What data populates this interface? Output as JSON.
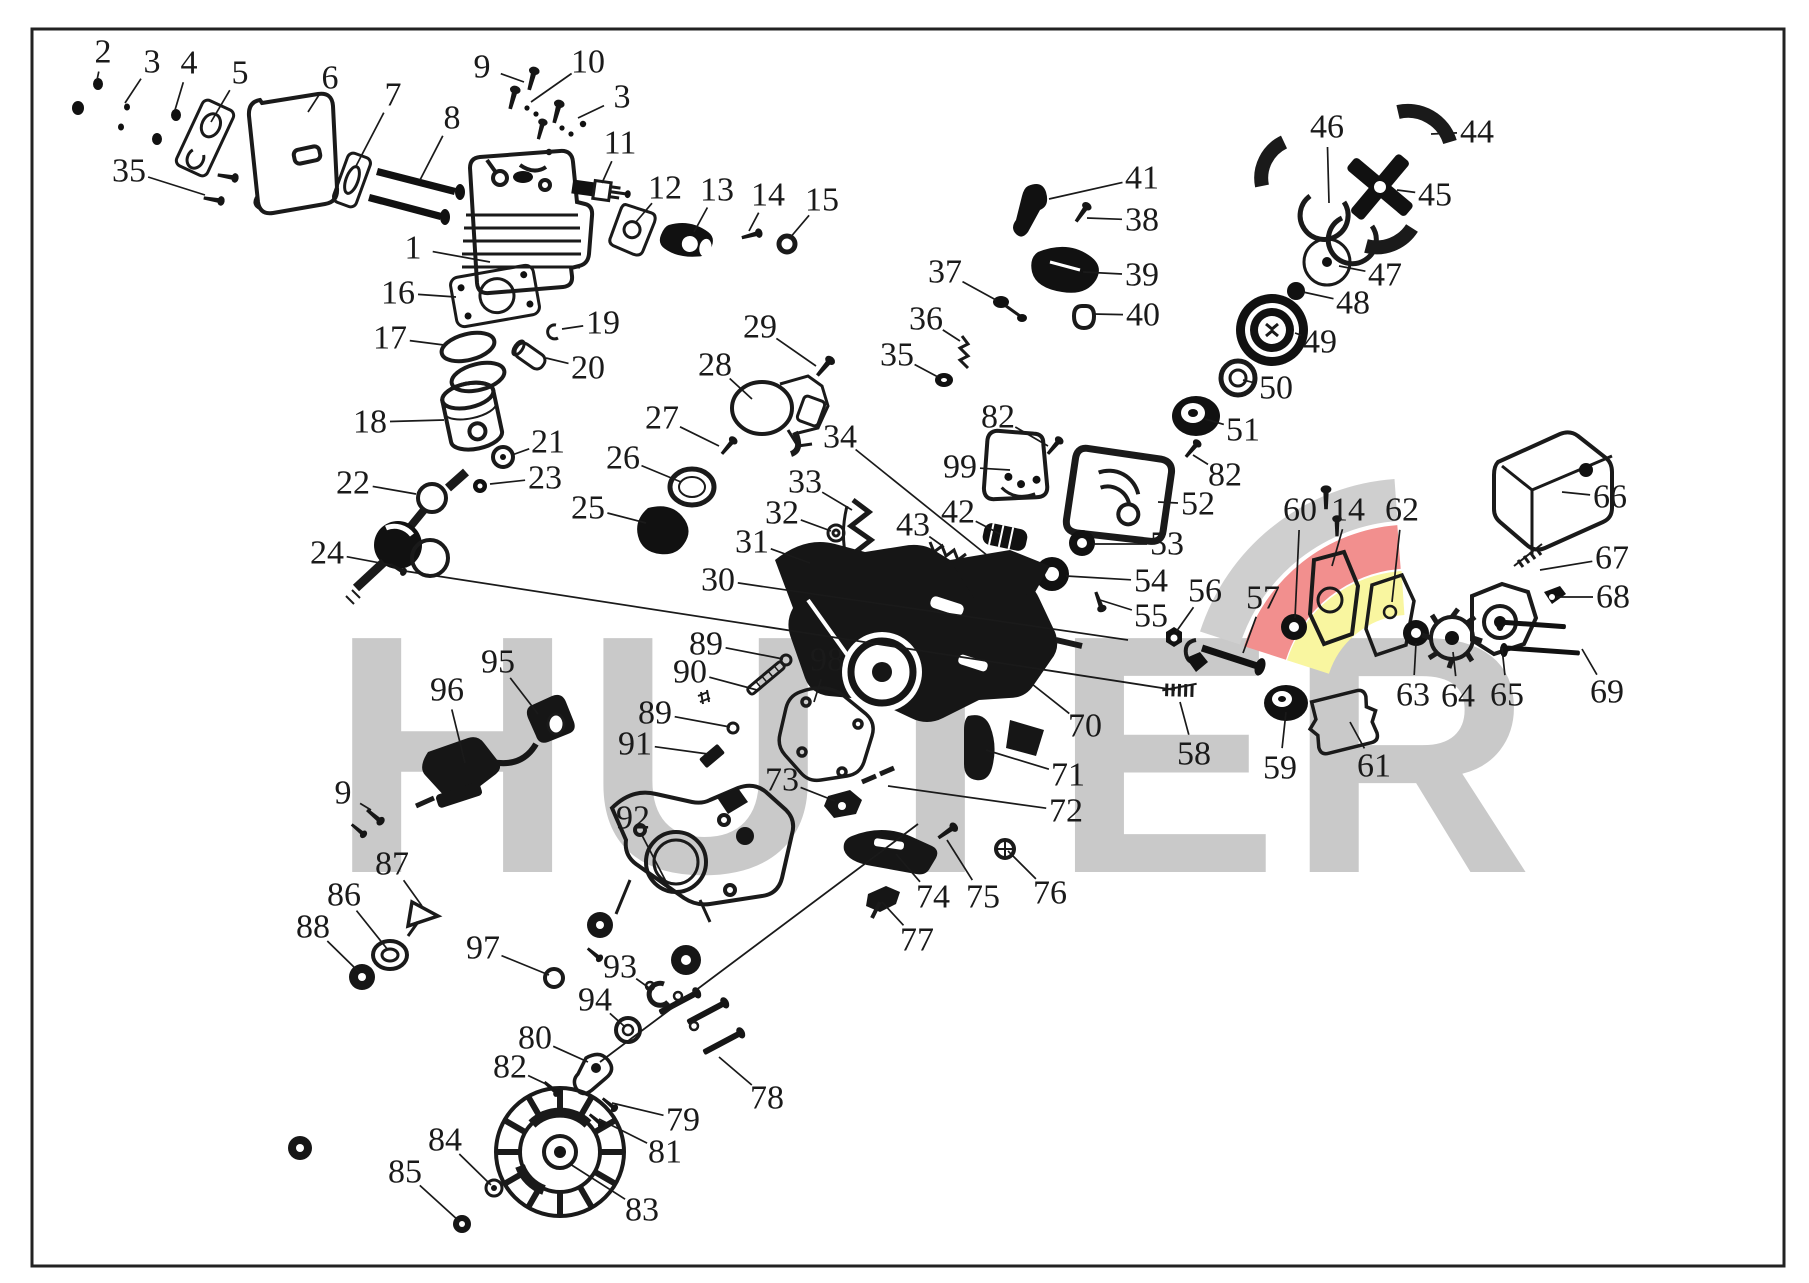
{
  "meta": {
    "kind": "exploded-parts-diagram",
    "canvas": {
      "width": 1809,
      "height": 1283,
      "background": "#ffffff"
    },
    "ink_color": "#1a1a1a",
    "frame": {
      "x": 32,
      "y": 29,
      "w": 1752,
      "h": 1237,
      "stroke": "#222222",
      "stroke_width": 3
    }
  },
  "watermark": {
    "text": "HUTER",
    "color": "#c9c9c9",
    "logo_arc_colors": {
      "gray": "#cfcfcf",
      "red": "#f28f8e",
      "yellow": "#f9f6a0"
    }
  },
  "style": {
    "label_font_size": 34,
    "leader_width": 1.7,
    "label_gap": 20
  },
  "callouts": [
    {
      "label": "1",
      "x": 413,
      "y": 248,
      "tx": 490,
      "ty": 262
    },
    {
      "label": "2",
      "x": 103,
      "y": 52,
      "tx": 97,
      "ty": 80
    },
    {
      "label": "3",
      "x": 152,
      "y": 62,
      "tx": 125,
      "ty": 103
    },
    {
      "label": "4",
      "x": 189,
      "y": 63,
      "tx": 175,
      "ty": 110
    },
    {
      "label": "5",
      "x": 240,
      "y": 73,
      "tx": 211,
      "ty": 122
    },
    {
      "label": "6",
      "x": 330,
      "y": 78,
      "tx": 308,
      "ty": 112
    },
    {
      "label": "7",
      "x": 393,
      "y": 95,
      "tx": 355,
      "ty": 168
    },
    {
      "label": "8",
      "x": 452,
      "y": 118,
      "tx": 420,
      "ty": 180
    },
    {
      "label": "9",
      "x": 482,
      "y": 67,
      "tx": 524,
      "ty": 82
    },
    {
      "label": "10",
      "x": 588,
      "y": 62,
      "tx": 531,
      "ty": 102
    },
    {
      "label": "3",
      "x": 622,
      "y": 97,
      "tx": 578,
      "ty": 118
    },
    {
      "label": "11",
      "x": 620,
      "y": 143,
      "tx": 602,
      "ty": 183
    },
    {
      "label": "12",
      "x": 665,
      "y": 188,
      "tx": 636,
      "ty": 222
    },
    {
      "label": "13",
      "x": 717,
      "y": 190,
      "tx": 694,
      "ty": 232
    },
    {
      "label": "14",
      "x": 768,
      "y": 195,
      "tx": 749,
      "ty": 231
    },
    {
      "label": "15",
      "x": 822,
      "y": 200,
      "tx": 789,
      "ty": 239
    },
    {
      "label": "16",
      "x": 398,
      "y": 293,
      "tx": 456,
      "ty": 297
    },
    {
      "label": "17",
      "x": 390,
      "y": 338,
      "tx": 444,
      "ty": 345
    },
    {
      "label": "18",
      "x": 370,
      "y": 422,
      "tx": 444,
      "ty": 420
    },
    {
      "label": "19",
      "x": 603,
      "y": 323,
      "tx": 562,
      "ty": 329
    },
    {
      "label": "20",
      "x": 588,
      "y": 368,
      "tx": 546,
      "ty": 358
    },
    {
      "label": "21",
      "x": 548,
      "y": 442,
      "tx": 512,
      "ty": 455
    },
    {
      "label": "22",
      "x": 353,
      "y": 483,
      "tx": 416,
      "ty": 494
    },
    {
      "label": "23",
      "x": 545,
      "y": 478,
      "tx": 490,
      "ty": 484
    },
    {
      "label": "24",
      "x": 327,
      "y": 553,
      "tx": 391,
      "ty": 565
    },
    {
      "label": "25",
      "x": 588,
      "y": 508,
      "tx": 646,
      "ty": 523
    },
    {
      "label": "26",
      "x": 623,
      "y": 458,
      "tx": 681,
      "ty": 482
    },
    {
      "label": "27",
      "x": 662,
      "y": 418,
      "tx": 719,
      "ty": 446
    },
    {
      "label": "28",
      "x": 715,
      "y": 365,
      "tx": 752,
      "ty": 399
    },
    {
      "label": "29",
      "x": 760,
      "y": 327,
      "tx": 816,
      "ty": 366
    },
    {
      "label": "30",
      "x": 718,
      "y": 580,
      "tx": 1128,
      "ty": 640
    },
    {
      "label": "31",
      "x": 752,
      "y": 542,
      "tx": 810,
      "ty": 563
    },
    {
      "label": "32",
      "x": 782,
      "y": 513,
      "tx": 831,
      "ty": 531
    },
    {
      "label": "33",
      "x": 805,
      "y": 482,
      "tx": 852,
      "ty": 510
    },
    {
      "label": "34",
      "x": 840,
      "y": 437,
      "tx": 988,
      "ty": 556
    },
    {
      "label": "35",
      "x": 129,
      "y": 171,
      "tx": 205,
      "ty": 195
    },
    {
      "label": "35",
      "x": 897,
      "y": 355,
      "tx": 938,
      "ty": 377
    },
    {
      "label": "36",
      "x": 926,
      "y": 319,
      "tx": 960,
      "ty": 341
    },
    {
      "label": "37",
      "x": 945,
      "y": 272,
      "tx": 996,
      "ty": 300
    },
    {
      "label": "38",
      "x": 1142,
      "y": 220,
      "tx": 1087,
      "ty": 218
    },
    {
      "label": "39",
      "x": 1142,
      "y": 275,
      "tx": 1083,
      "ty": 272
    },
    {
      "label": "40",
      "x": 1143,
      "y": 315,
      "tx": 1093,
      "ty": 314
    },
    {
      "label": "41",
      "x": 1142,
      "y": 178,
      "tx": 1049,
      "ty": 199
    },
    {
      "label": "42",
      "x": 958,
      "y": 512,
      "tx": 1000,
      "ty": 534
    },
    {
      "label": "43",
      "x": 913,
      "y": 525,
      "tx": 944,
      "ty": 547
    },
    {
      "label": "44",
      "x": 1477,
      "y": 132,
      "tx": 1431,
      "ty": 134
    },
    {
      "label": "45",
      "x": 1435,
      "y": 195,
      "tx": 1397,
      "ty": 190
    },
    {
      "label": "46",
      "x": 1327,
      "y": 127,
      "tx": 1329,
      "ty": 203
    },
    {
      "label": "47",
      "x": 1385,
      "y": 275,
      "tx": 1339,
      "ty": 266
    },
    {
      "label": "48",
      "x": 1353,
      "y": 303,
      "tx": 1303,
      "ty": 292
    },
    {
      "label": "49",
      "x": 1320,
      "y": 342,
      "tx": 1295,
      "ty": 333
    },
    {
      "label": "50",
      "x": 1276,
      "y": 388,
      "tx": 1243,
      "ty": 380
    },
    {
      "label": "51",
      "x": 1243,
      "y": 430,
      "tx": 1205,
      "ty": 419
    },
    {
      "label": "52",
      "x": 1198,
      "y": 504,
      "tx": 1158,
      "ty": 502
    },
    {
      "label": "53",
      "x": 1167,
      "y": 544,
      "tx": 1093,
      "ty": 544
    },
    {
      "label": "54",
      "x": 1151,
      "y": 581,
      "tx": 1066,
      "ty": 576
    },
    {
      "label": "55",
      "x": 1151,
      "y": 616,
      "tx": 1100,
      "ty": 600
    },
    {
      "label": "56",
      "x": 1205,
      "y": 591,
      "tx": 1176,
      "ty": 632
    },
    {
      "label": "57",
      "x": 1263,
      "y": 598,
      "tx": 1243,
      "ty": 653
    },
    {
      "label": "58",
      "x": 1194,
      "y": 754,
      "tx": 1180,
      "ty": 702
    },
    {
      "label": "59",
      "x": 1280,
      "y": 768,
      "tx": 1286,
      "ty": 712
    },
    {
      "label": "60",
      "x": 1300,
      "y": 510,
      "tx": 1295,
      "ty": 618
    },
    {
      "label": "61",
      "x": 1374,
      "y": 766,
      "tx": 1350,
      "ty": 722
    },
    {
      "label": "62",
      "x": 1402,
      "y": 510,
      "tx": 1392,
      "ty": 602
    },
    {
      "label": "63",
      "x": 1413,
      "y": 695,
      "tx": 1416,
      "ty": 643
    },
    {
      "label": "64",
      "x": 1458,
      "y": 696,
      "tx": 1453,
      "ty": 652
    },
    {
      "label": "65",
      "x": 1507,
      "y": 695,
      "tx": 1502,
      "ty": 648
    },
    {
      "label": "66",
      "x": 1610,
      "y": 497,
      "tx": 1562,
      "ty": 492
    },
    {
      "label": "67",
      "x": 1612,
      "y": 558,
      "tx": 1540,
      "ty": 570
    },
    {
      "label": "68",
      "x": 1613,
      "y": 597,
      "tx": 1556,
      "ty": 597
    },
    {
      "label": "69",
      "x": 1607,
      "y": 692,
      "tx": 1582,
      "ty": 649
    },
    {
      "label": "70",
      "x": 1085,
      "y": 726,
      "tx": 1032,
      "ty": 684
    },
    {
      "label": "71",
      "x": 1068,
      "y": 775,
      "tx": 986,
      "ty": 750
    },
    {
      "label": "72",
      "x": 1066,
      "y": 811,
      "tx": 888,
      "ty": 786
    },
    {
      "label": "73",
      "x": 782,
      "y": 780,
      "tx": 835,
      "ty": 801
    },
    {
      "label": "74",
      "x": 933,
      "y": 897,
      "tx": 896,
      "ty": 854
    },
    {
      "label": "75",
      "x": 983,
      "y": 897,
      "tx": 947,
      "ty": 840
    },
    {
      "label": "76",
      "x": 1050,
      "y": 893,
      "tx": 1008,
      "ty": 851
    },
    {
      "label": "77",
      "x": 917,
      "y": 940,
      "tx": 882,
      "ty": 902
    },
    {
      "label": "78",
      "x": 767,
      "y": 1098,
      "tx": 719,
      "ty": 1057
    },
    {
      "label": "79",
      "x": 683,
      "y": 1120,
      "tx": 612,
      "ty": 1103
    },
    {
      "label": "80",
      "x": 535,
      "y": 1038,
      "tx": 588,
      "ty": 1062
    },
    {
      "label": "81",
      "x": 665,
      "y": 1152,
      "tx": 599,
      "ty": 1119
    },
    {
      "label": "82",
      "x": 998,
      "y": 417,
      "tx": 1048,
      "ty": 446
    },
    {
      "label": "82",
      "x": 1225,
      "y": 475,
      "tx": 1193,
      "ty": 455
    },
    {
      "label": "82",
      "x": 510,
      "y": 1067,
      "tx": 546,
      "ty": 1084
    },
    {
      "label": "83",
      "x": 642,
      "y": 1210,
      "tx": 570,
      "ty": 1164
    },
    {
      "label": "84",
      "x": 445,
      "y": 1140,
      "tx": 491,
      "ty": 1185
    },
    {
      "label": "85",
      "x": 405,
      "y": 1172,
      "tx": 459,
      "ty": 1221
    },
    {
      "label": "86",
      "x": 344,
      "y": 895,
      "tx": 388,
      "ty": 950
    },
    {
      "label": "87",
      "x": 392,
      "y": 864,
      "tx": 422,
      "ty": 906
    },
    {
      "label": "88",
      "x": 313,
      "y": 927,
      "tx": 359,
      "ty": 972
    },
    {
      "label": "89",
      "x": 706,
      "y": 644,
      "tx": 783,
      "ty": 659
    },
    {
      "label": "90",
      "x": 690,
      "y": 672,
      "tx": 757,
      "ty": 690
    },
    {
      "label": "89",
      "x": 655,
      "y": 713,
      "tx": 730,
      "ty": 727
    },
    {
      "label": "91",
      "x": 635,
      "y": 744,
      "tx": 708,
      "ty": 754
    },
    {
      "label": "92",
      "x": 633,
      "y": 818,
      "tx": 672,
      "ty": 893
    },
    {
      "label": "93",
      "x": 620,
      "y": 967,
      "tx": 652,
      "ty": 990
    },
    {
      "label": "94",
      "x": 595,
      "y": 1000,
      "tx": 624,
      "ty": 1026
    },
    {
      "label": "95",
      "x": 498,
      "y": 662,
      "tx": 538,
      "ty": 714
    },
    {
      "label": "96",
      "x": 447,
      "y": 690,
      "tx": 465,
      "ty": 763
    },
    {
      "label": "97",
      "x": 483,
      "y": 948,
      "tx": 549,
      "ty": 975
    },
    {
      "label": "98",
      "x": 827,
      "y": 660,
      "tx": 814,
      "ty": 702
    },
    {
      "label": "99",
      "x": 960,
      "y": 467,
      "tx": 1010,
      "ty": 470
    },
    {
      "label": "9",
      "x": 343,
      "y": 793,
      "tx": 371,
      "ty": 810
    },
    {
      "label": "14",
      "x": 1348,
      "y": 510,
      "tx": 1332,
      "ty": 566
    }
  ]
}
